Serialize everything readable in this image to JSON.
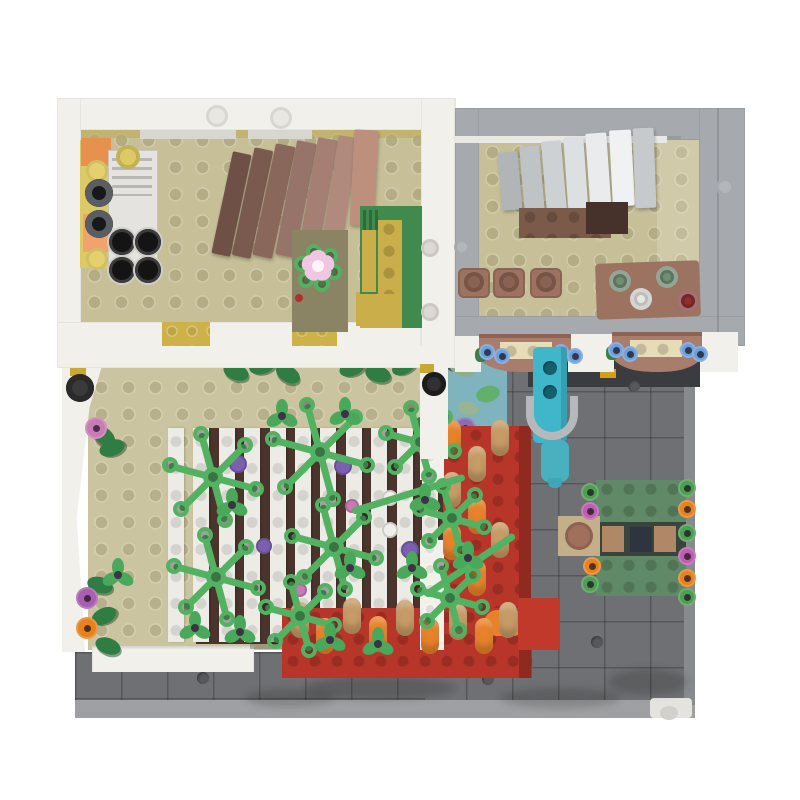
{
  "meta": {
    "title": "Top-down view of a LEGO modular building MOC",
    "background": "#ffffff"
  },
  "scene": {
    "type": "lego-moc-top-view",
    "areas": {
      "upper_left_room": "kitchen and dining room with tan studded floor",
      "upper_right_room": "stair room with gray walls, fan staircase, bar stools and bottle table",
      "terrace": "walled terrace with pergola trellis overgrown with vines",
      "flower_beds": "red brick flower beds with orange and tan blossom cylinders",
      "plaza": "dark gray tiled plaza with water pump, pond and picnic benches"
    }
  },
  "palette": {
    "white_wall": "#f2f0ea",
    "gray_wall": "#a6a9ad",
    "tan_floor": "#c6bf98",
    "terrace_floor": "#cbc4a0",
    "plaza": "#6e7073",
    "plaza_light": "#9ea0a3",
    "vine_green": "#53b262",
    "leaf_green": "#4aa85a",
    "dark_leaf": "#2f7d42",
    "red_bed": "#b73629",
    "red_dark": "#8e2a20",
    "orange": "#e8822a",
    "tan_cyl": "#c79b66",
    "teal_pump": "#3fb6c9",
    "water": "#7fb3bd",
    "bench_green": "#608967",
    "sofa_green": "#3f8a4c",
    "sofa_yellow": "#caae4a",
    "kitchen_yellow": "#ddca62",
    "kitchen_orange": "#e8914f",
    "table_brown": "#9c7260",
    "awning_brown": "#a87d6d",
    "awning_tan": "#e7dcb8",
    "blue_flower": "#6f9fd8",
    "purple": "#7c5fae",
    "magenta": "#bd5fae",
    "pink": "#d389bc",
    "pale_pink": "#f0c6e2"
  },
  "decor": {
    "stairs_slats": [
      [
        500,
        152,
        20,
        58,
        -5,
        "#b2b5b8"
      ],
      [
        522,
        146,
        20,
        66,
        -5,
        "#c0c3c6"
      ],
      [
        544,
        141,
        20,
        72,
        -5,
        "#ced1d3"
      ],
      [
        566,
        137,
        20,
        78,
        -4,
        "#dde0e2"
      ],
      [
        588,
        133,
        21,
        80,
        -4,
        "#e9ebec"
      ],
      [
        611,
        130,
        22,
        76,
        -3,
        "#f0f1f2"
      ],
      [
        634,
        128,
        21,
        80,
        -2,
        "#c7cacd"
      ]
    ],
    "dining_slats": [
      [
        222,
        152,
        19,
        104,
        12,
        "#6e5046"
      ],
      [
        243,
        148,
        19,
        110,
        12,
        "#7a594e"
      ],
      [
        264,
        144,
        20,
        114,
        12,
        "#8a675b"
      ],
      [
        286,
        141,
        20,
        116,
        11,
        "#97746a"
      ],
      [
        308,
        138,
        20,
        116,
        10,
        "#a57f73"
      ],
      [
        330,
        136,
        20,
        112,
        9,
        "#b08a7c"
      ],
      [
        352,
        130,
        24,
        96,
        3,
        "#bd8f7d"
      ]
    ],
    "trellis": {
      "count": 11,
      "x0": 168,
      "step": 25.4,
      "y": 428,
      "w": 16,
      "h": 214,
      "color": "#ecebe5"
    },
    "vine_stars": [
      {
        "x": 213,
        "y": 477,
        "r": 54
      },
      {
        "x": 216,
        "y": 577,
        "r": 52
      },
      {
        "x": 320,
        "y": 452,
        "r": 58
      },
      {
        "x": 334,
        "y": 547,
        "r": 52
      },
      {
        "x": 300,
        "y": 616,
        "r": 44
      },
      {
        "x": 420,
        "y": 442,
        "r": 44
      },
      {
        "x": 452,
        "y": 518,
        "r": 42
      },
      {
        "x": 450,
        "y": 598,
        "r": 42
      }
    ],
    "branches": [
      {
        "x": 352,
        "y": 508,
        "len": 118,
        "rot": -17
      },
      {
        "x": 425,
        "y": 592,
        "len": 108,
        "rot": -34
      }
    ],
    "trefoils": [
      {
        "x": 282,
        "y": 416
      },
      {
        "x": 345,
        "y": 414
      },
      {
        "x": 232,
        "y": 505
      },
      {
        "x": 425,
        "y": 500
      },
      {
        "x": 350,
        "y": 568
      },
      {
        "x": 412,
        "y": 568
      },
      {
        "x": 468,
        "y": 558
      },
      {
        "x": 330,
        "y": 640
      },
      {
        "x": 378,
        "y": 644
      },
      {
        "x": 195,
        "y": 628
      },
      {
        "x": 240,
        "y": 632
      },
      {
        "x": 118,
        "y": 575
      }
    ],
    "slat_dots": [
      {
        "x": 238,
        "y": 464,
        "r": 9,
        "c": "#7c5fae"
      },
      {
        "x": 343,
        "y": 466,
        "r": 9,
        "c": "#7c5fae"
      },
      {
        "x": 410,
        "y": 550,
        "r": 9,
        "c": "#7c5fae"
      },
      {
        "x": 264,
        "y": 546,
        "r": 8,
        "c": "#7c5fae"
      },
      {
        "x": 352,
        "y": 506,
        "r": 7,
        "c": "#c979b6"
      },
      {
        "x": 300,
        "y": 590,
        "r": 7,
        "c": "#c979b6"
      },
      {
        "x": 390,
        "y": 498,
        "r": 8,
        "c": "#efefec"
      },
      {
        "x": 390,
        "y": 530,
        "r": 8,
        "c": "#efefec"
      }
    ],
    "red_pills": [
      {
        "x": 452,
        "y": 438,
        "c": "#e8822a"
      },
      {
        "x": 452,
        "y": 490,
        "c": "#c79b66"
      },
      {
        "x": 452,
        "y": 542,
        "c": "#e8822a"
      },
      {
        "x": 477,
        "y": 464,
        "c": "#c79b66"
      },
      {
        "x": 477,
        "y": 516,
        "c": "#e8822a"
      },
      {
        "x": 500,
        "y": 438,
        "c": "#c79b66"
      },
      {
        "x": 500,
        "y": 540,
        "c": "#c79b66"
      },
      {
        "x": 477,
        "y": 578,
        "c": "#e8822a"
      },
      {
        "x": 300,
        "y": 620,
        "c": "#c79b66"
      },
      {
        "x": 325,
        "y": 636,
        "c": "#e8822a"
      },
      {
        "x": 352,
        "y": 616,
        "c": "#c79b66"
      },
      {
        "x": 378,
        "y": 634,
        "c": "#e8822a"
      },
      {
        "x": 405,
        "y": 618,
        "c": "#c79b66"
      },
      {
        "x": 430,
        "y": 636,
        "c": "#e8822a"
      },
      {
        "x": 458,
        "y": 622,
        "c": "#c79b66"
      },
      {
        "x": 484,
        "y": 636,
        "c": "#e8822a"
      },
      {
        "x": 508,
        "y": 620,
        "c": "#c79b66"
      }
    ],
    "plaza_studs": [
      {
        "x": 634,
        "y": 386
      },
      {
        "x": 597,
        "y": 642
      },
      {
        "x": 488,
        "y": 679
      },
      {
        "x": 203,
        "y": 678
      }
    ],
    "plant_shadows": [
      {
        "x": 380,
        "y": 688,
        "w": 150,
        "h": 24
      },
      {
        "x": 560,
        "y": 698,
        "w": 120,
        "h": 20
      },
      {
        "x": 290,
        "y": 698,
        "w": 90,
        "h": 18
      },
      {
        "x": 648,
        "y": 682,
        "w": 80,
        "h": 26
      }
    ],
    "leaf_clusters": [
      {
        "x": 236,
        "y": 372,
        "rot": 20
      },
      {
        "x": 262,
        "y": 366,
        "rot": -15
      },
      {
        "x": 288,
        "y": 374,
        "rot": 30
      },
      {
        "x": 352,
        "y": 368,
        "rot": -20
      },
      {
        "x": 378,
        "y": 374,
        "rot": 15
      },
      {
        "x": 404,
        "y": 366,
        "rot": -30
      },
      {
        "x": 104,
        "y": 436,
        "rot": 40
      },
      {
        "x": 112,
        "y": 448,
        "rot": -20
      },
      {
        "x": 100,
        "y": 585,
        "rot": 15
      },
      {
        "x": 104,
        "y": 616,
        "rot": -25
      },
      {
        "x": 108,
        "y": 646,
        "rot": 20
      },
      {
        "x": 428,
        "y": 424,
        "rot": 10
      },
      {
        "x": 426,
        "y": 444,
        "rot": -30
      }
    ],
    "bench_flowers": [
      {
        "x": 590,
        "y": 492,
        "c": "#4f9e54"
      },
      {
        "x": 590,
        "y": 511,
        "c": "#bd5fae"
      },
      {
        "x": 592,
        "y": 566,
        "c": "#e8821e"
      },
      {
        "x": 590,
        "y": 584,
        "c": "#4f9e54"
      },
      {
        "x": 687,
        "y": 488,
        "c": "#4f9e54"
      },
      {
        "x": 687,
        "y": 509,
        "c": "#e8821e"
      },
      {
        "x": 687,
        "y": 533,
        "c": "#4f9e54"
      },
      {
        "x": 687,
        "y": 556,
        "c": "#bd5fae"
      },
      {
        "x": 687,
        "y": 578,
        "c": "#e8821e"
      },
      {
        "x": 687,
        "y": 597,
        "c": "#4f9e54"
      }
    ],
    "terrace_flowers": [
      {
        "x": 96,
        "y": 428,
        "c": "#c97bb4"
      },
      {
        "x": 87,
        "y": 598,
        "c": "#a85fb0"
      },
      {
        "x": 87,
        "y": 628,
        "c": "#e8821e"
      },
      {
        "x": 433,
        "y": 406,
        "c": "#e8821e"
      },
      {
        "x": 465,
        "y": 428,
        "c": "#8a6fae"
      }
    ],
    "awning_flowers": [
      {
        "x": 487,
        "y": 352
      },
      {
        "x": 502,
        "y": 356
      },
      {
        "x": 561,
        "y": 352
      },
      {
        "x": 575,
        "y": 356
      },
      {
        "x": 616,
        "y": 350
      },
      {
        "x": 630,
        "y": 354
      },
      {
        "x": 688,
        "y": 350
      },
      {
        "x": 700,
        "y": 354
      }
    ],
    "bottles": [
      {
        "x": 620,
        "y": 281,
        "c": "#6f8f74"
      },
      {
        "x": 667,
        "y": 277,
        "c": "#6f8f74"
      },
      {
        "x": 641,
        "y": 299,
        "c": "#e9e7e3"
      },
      {
        "x": 688,
        "y": 301,
        "c": "#8e2f2f"
      }
    ],
    "kitchen_burners": [
      {
        "x": 122,
        "y": 242
      },
      {
        "x": 148,
        "y": 242
      },
      {
        "x": 122,
        "y": 270
      },
      {
        "x": 148,
        "y": 270
      }
    ],
    "kitchen_pots": [
      {
        "x": 99,
        "y": 193
      },
      {
        "x": 99,
        "y": 224
      }
    ],
    "stools": [
      {
        "x": 474,
        "y": 282
      },
      {
        "x": 509,
        "y": 282
      },
      {
        "x": 546,
        "y": 282
      }
    ],
    "water_pads": [
      {
        "x": 462,
        "y": 368,
        "w": 26,
        "h": 16,
        "rot": 20,
        "c": "#8fae8f"
      },
      {
        "x": 488,
        "y": 394,
        "w": 24,
        "h": 16,
        "rot": -15,
        "c": "#63b06a"
      },
      {
        "x": 468,
        "y": 408,
        "w": 22,
        "h": 13,
        "rot": 10,
        "c": "#97b595"
      }
    ],
    "wall_studs": [
      {
        "x": 217,
        "y": 116,
        "r": 11,
        "c": "#e9e7e1"
      },
      {
        "x": 281,
        "y": 118,
        "r": 11,
        "c": "#e9e7e1"
      },
      {
        "x": 430,
        "y": 248,
        "r": 9,
        "c": "#dcd9d3"
      },
      {
        "x": 430,
        "y": 312,
        "r": 9,
        "c": "#dcd9d3"
      },
      {
        "x": 725,
        "y": 187,
        "r": 9,
        "c": "#b4b7ba"
      },
      {
        "x": 462,
        "y": 247,
        "r": 8,
        "c": "#b4b7ba"
      }
    ],
    "sofa_plant": {
      "x": 318,
      "y": 268,
      "r": 26,
      "flower_x": 318,
      "flower_y": 266
    },
    "pump_holes": [
      {
        "x": 550,
        "y": 368
      },
      {
        "x": 550,
        "y": 392
      }
    ]
  }
}
